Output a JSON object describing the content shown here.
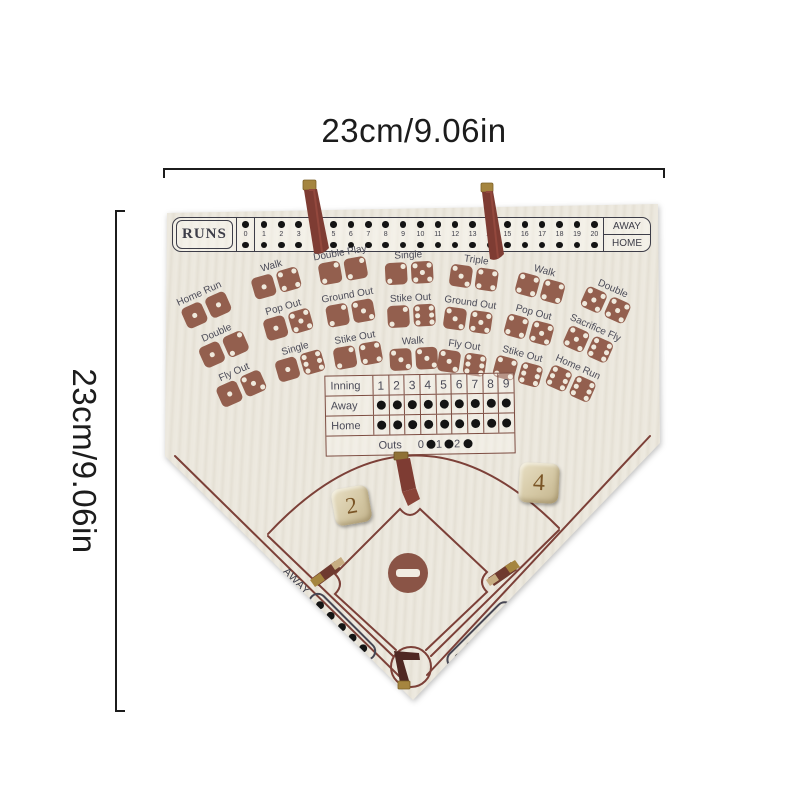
{
  "dimension_labels": {
    "top": "23cm/9.06in",
    "left": "23cm/9.06in"
  },
  "runs_track": {
    "title": "RUNS",
    "numbers": [
      "0",
      "1",
      "2",
      "3",
      "4",
      "5",
      "6",
      "7",
      "8",
      "9",
      "10",
      "11",
      "12",
      "13",
      "14",
      "15",
      "16",
      "17",
      "18",
      "19",
      "20"
    ],
    "away_label": "AWAY",
    "home_label": "HOME"
  },
  "outcome_grid": {
    "columns": [
      {
        "cells": [
          {
            "label": "Home Run",
            "dice": [
              1,
              1
            ]
          },
          {
            "label": "Double",
            "dice": [
              1,
              2
            ]
          },
          {
            "label": "Fly Out",
            "dice": [
              1,
              3
            ]
          }
        ]
      },
      {
        "cells": [
          {
            "label": "Walk",
            "dice": [
              1,
              4
            ]
          },
          {
            "label": "Pop Out",
            "dice": [
              1,
              5
            ]
          },
          {
            "label": "Single",
            "dice": [
              1,
              6
            ]
          }
        ]
      },
      {
        "cells": [
          {
            "label": "Double Play",
            "dice": [
              2,
              2
            ]
          },
          {
            "label": "Ground Out",
            "dice": [
              2,
              3
            ]
          },
          {
            "label": "Stike Out",
            "dice": [
              2,
              4
            ]
          }
        ]
      },
      {
        "cells": [
          {
            "label": "Single",
            "dice": [
              2,
              5
            ]
          },
          {
            "label": "Stike Out",
            "dice": [
              2,
              6
            ]
          },
          {
            "label": "Walk",
            "dice": [
              3,
              3
            ]
          }
        ]
      },
      {
        "cells": [
          {
            "label": "Triple",
            "dice": [
              3,
              4
            ]
          },
          {
            "label": "Ground Out",
            "dice": [
              3,
              5
            ]
          },
          {
            "label": "Fly Out",
            "dice": [
              3,
              6
            ]
          }
        ]
      },
      {
        "cells": [
          {
            "label": "Walk",
            "dice": [
              4,
              4
            ]
          },
          {
            "label": "Pop Out",
            "dice": [
              4,
              5
            ]
          },
          {
            "label": "Stike Out",
            "dice": [
              4,
              6
            ]
          }
        ]
      },
      {
        "cells": [
          {
            "label": "Double",
            "dice": [
              5,
              5
            ]
          },
          {
            "label": "Sacrifice Fly",
            "dice": [
              5,
              6
            ]
          },
          {
            "label": "Home Run",
            "dice": [
              6,
              6
            ]
          }
        ]
      }
    ]
  },
  "scoreboard": {
    "inning_label": "Inning",
    "inning_numbers": [
      "1",
      "2",
      "3",
      "4",
      "5",
      "6",
      "7",
      "8",
      "9"
    ],
    "away_label": "Away",
    "home_label": "Home",
    "outs_label": "Outs",
    "outs_numbers": [
      "0",
      "1",
      "2"
    ]
  },
  "field": {
    "away_track_label": "AWAY",
    "home_track_label": "HOME"
  },
  "loose_dice": [
    {
      "value": "2"
    },
    {
      "value": "4"
    }
  ],
  "colors": {
    "board_bg": "#ece8de",
    "dice_print": "#935f4e",
    "field_line": "#7c4038",
    "label_ink": "#4b4b58",
    "track_ink": "#3d3d48",
    "dot_black": "#141414",
    "strap_leather": "#7e3c33",
    "brass": "#a5853f",
    "die_wood": "#dccfa9",
    "scoreboard_line": "#7d4d42",
    "dimension_ink": "#1c1c1c"
  }
}
